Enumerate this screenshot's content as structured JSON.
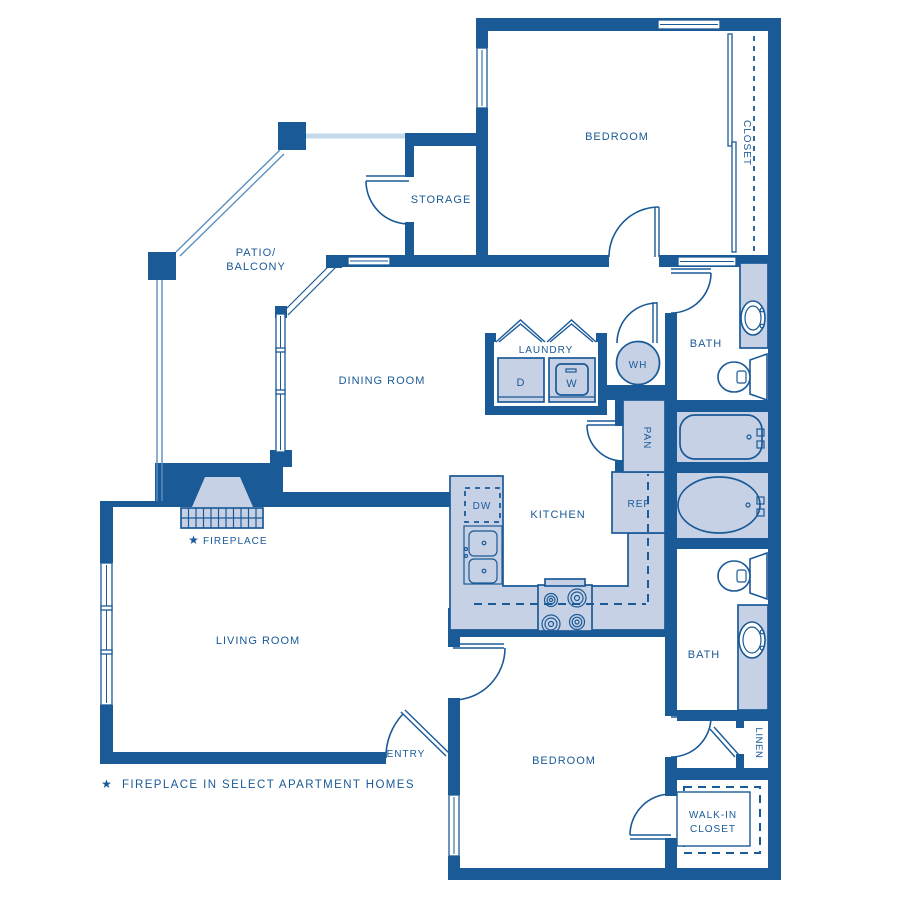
{
  "plan": {
    "title": "Two bedroom two bath apartment floor plan",
    "labels": {
      "bedroom_top": "BEDROOM",
      "closet_top": "CLOSET",
      "storage": "STORAGE",
      "patio_line1": "PATIO/",
      "patio_line2": "BALCONY",
      "dining_room": "DINING ROOM",
      "laundry": "LAUNDRY",
      "dryer": "D",
      "washer": "W",
      "water_heater": "WH",
      "bath_upper": "BATH",
      "pantry": "PAN",
      "kitchen": "KITCHEN",
      "dishwasher": "DW",
      "refrigerator": "REF",
      "living_room": "LIVING ROOM",
      "fireplace_marker": "★",
      "fireplace": "FIREPLACE",
      "entry": "ENTRY",
      "bedroom_bottom": "BEDROOM",
      "bath_lower": "BATH",
      "linen": "LINEN",
      "walkin_line1": "WALK-IN",
      "walkin_line2": "CLOSET"
    },
    "footnote": {
      "marker": "★",
      "text": "FIREPLACE IN SELECT APARTMENT HOMES"
    },
    "colors": {
      "wall": "#1a5a97",
      "fixture_fill": "#c7d1e6",
      "railing_light": "#c3d9ec",
      "railing_mid": "#5b8fc0",
      "text": "#1a5a97",
      "background": "#ffffff"
    }
  }
}
